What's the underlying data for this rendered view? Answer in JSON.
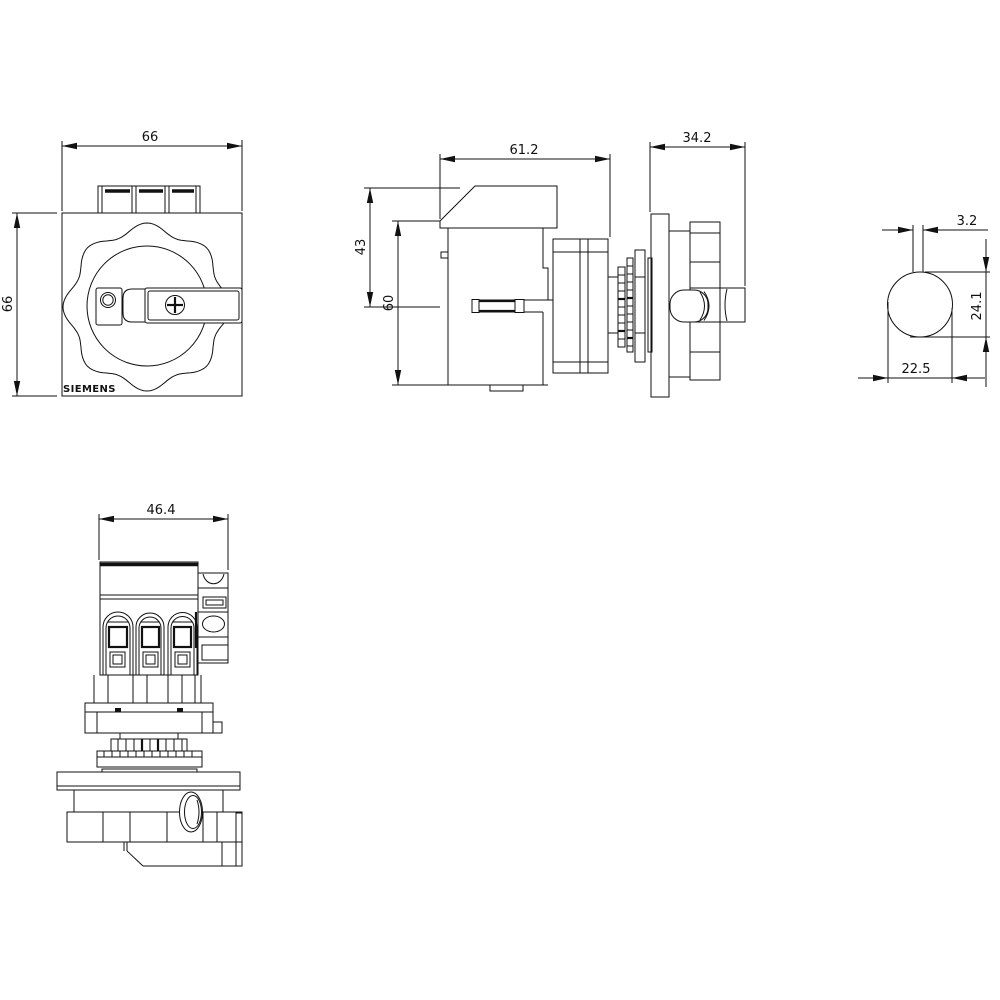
{
  "drawing": {
    "brand": "SIEMENS",
    "line_color": "#111111",
    "background_color": "#ffffff",
    "dimensions": {
      "front_width": "66",
      "front_height": "66",
      "side_body_width": "61.2",
      "side_upper_height": "43",
      "side_body_height": "60",
      "side_knob_depth": "34.2",
      "shaft_slot_width": "3.2",
      "shaft_section_height": "24.1",
      "shaft_section_width": "22.5",
      "bottom_view_width": "46.4"
    }
  }
}
